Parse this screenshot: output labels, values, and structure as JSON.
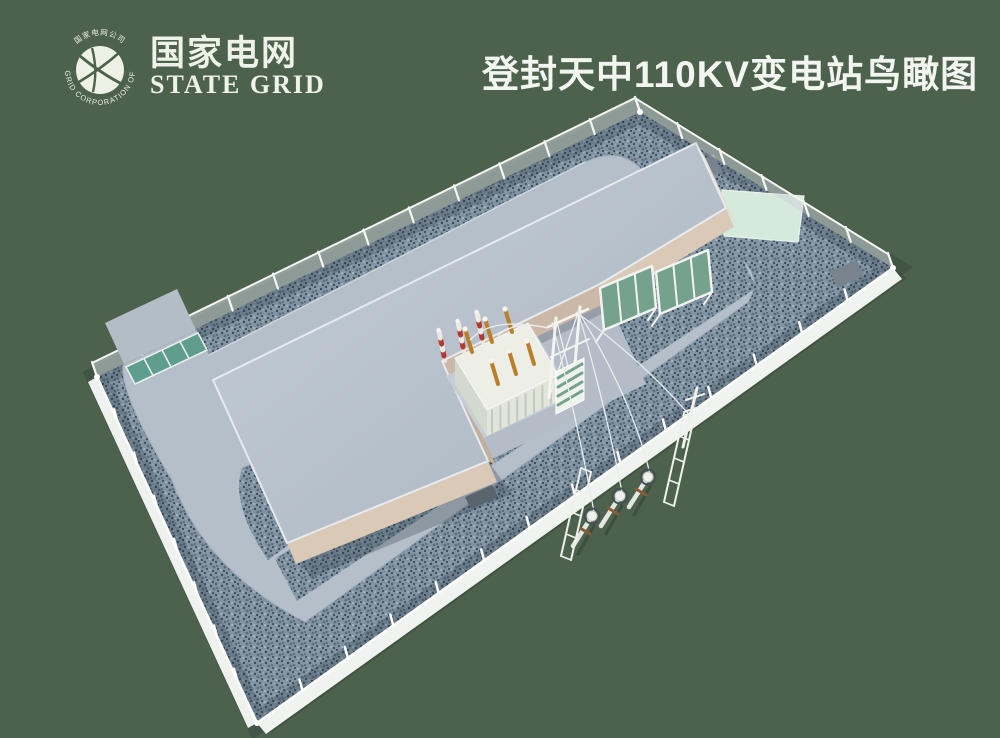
{
  "header": {
    "logo": {
      "ring_text_top": "国家电网公司",
      "ring_text_bottom": "STATE GRID CORPORATION OF CHINA",
      "brand_cn": "国家电网",
      "brand_en": "STATE GRID"
    },
    "title": "登封天中110KV变电站鸟瞰图"
  },
  "scene": {
    "parts": [
      "perimeter-wall",
      "chain-link-fence",
      "entrance-gate",
      "gate-apron",
      "ring-road",
      "gravel-yard",
      "main-building",
      "equipment-wing",
      "transformer-courtyard",
      "main-transformer",
      "transformer-bushings",
      "surge-arresters",
      "outgoing-gantry",
      "switch-screens",
      "mint-pad",
      "equipment-pads",
      "transmission-poles",
      "guy-ladders",
      "overhead-wires"
    ]
  },
  "colors": {
    "background": "#4d624d",
    "shadow": "#415441",
    "gravel_base": "#8094a4",
    "pavement": "#b5bfc9",
    "roof_light": "#c6cfd8",
    "roof_dark": "#aab4bf",
    "wall_tan_lit": "#dbc9b7",
    "wall_tan_shade": "#c9b6a5",
    "wall_white": "#eef1ee",
    "gate_teal": "#5f9e8e",
    "mint_pad": "#d5eadd",
    "screen_green": "#74a28c",
    "transformer_body": "#edefe7",
    "bushing_orange": "#b97f2a",
    "arrester_red": "#b23b31",
    "pole_arm_brown": "#8a5a3c",
    "wire": "#e9edee",
    "title_text": "#f3f6f0"
  }
}
